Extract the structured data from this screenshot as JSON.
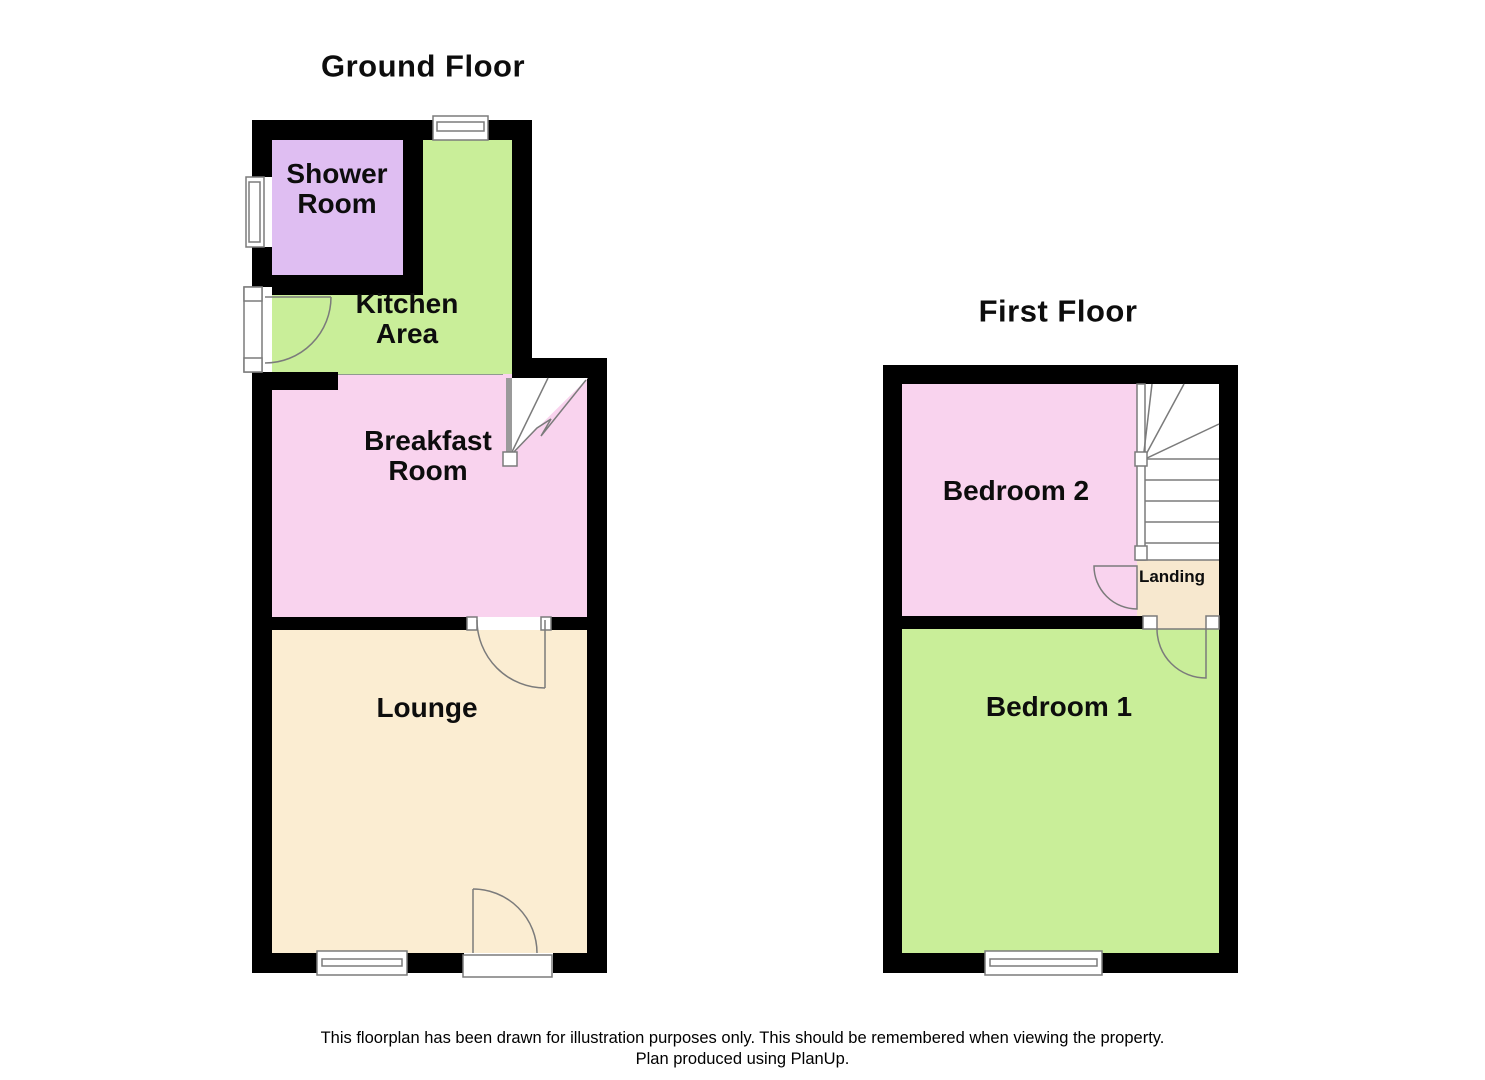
{
  "ground_floor": {
    "title": "Ground Floor",
    "rooms": [
      {
        "id": "shower-room",
        "label": "Shower\nRoom",
        "color": "#dfbef2"
      },
      {
        "id": "kitchen-area",
        "label": "Kitchen\nArea",
        "color": "#c9ee99"
      },
      {
        "id": "breakfast-room",
        "label": "Breakfast\nRoom",
        "color": "#f9d3ee"
      },
      {
        "id": "lounge",
        "label": "Lounge",
        "color": "#fbedd2"
      }
    ]
  },
  "first_floor": {
    "title": "First Floor",
    "rooms": [
      {
        "id": "bedroom-2",
        "label": "Bedroom 2",
        "color": "#f9d3ee"
      },
      {
        "id": "landing",
        "label": "Landing",
        "color": "#f7e8cf"
      },
      {
        "id": "bedroom-1",
        "label": "Bedroom 1",
        "color": "#c9ee99"
      }
    ]
  },
  "footer": {
    "line1": "This floorplan has been drawn for illustration purposes only. This should be remembered when viewing the property.",
    "line2": "Plan produced using PlanUp."
  },
  "colors": {
    "wall": "#000000",
    "outline": "#7b7b7b",
    "stair_stringer": "#9a9a9a",
    "background": "#ffffff"
  }
}
